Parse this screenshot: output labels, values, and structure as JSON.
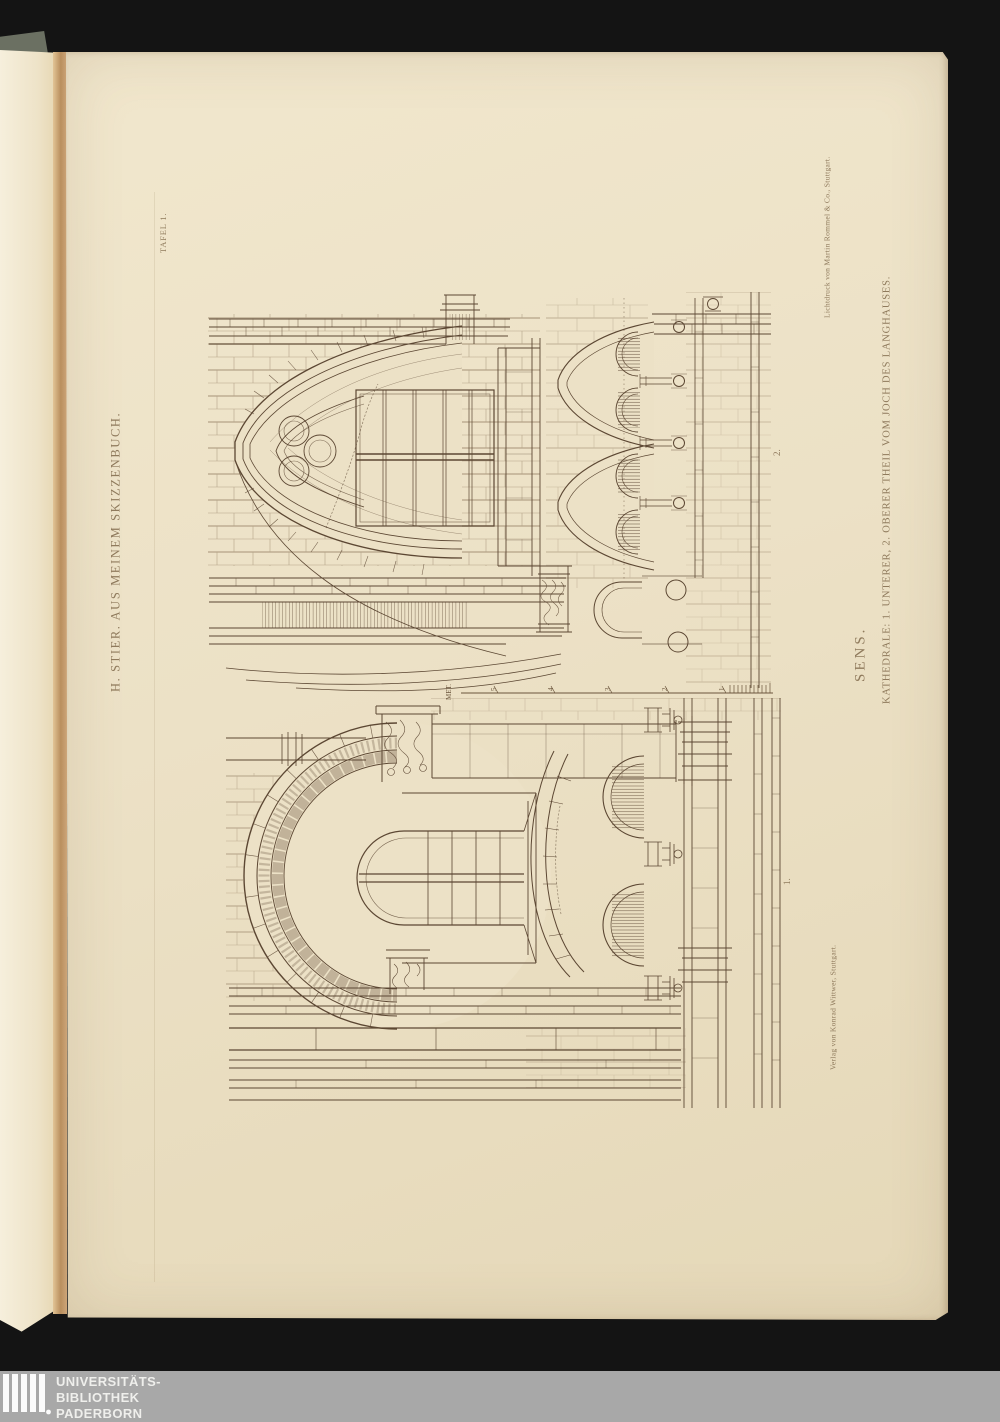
{
  "plate": {
    "tafel_label": "TAFEL 1.",
    "series_title": "H. STIER. AUS MEINEM SKIZZENBUCH.",
    "printer_credit": "Lichtdruck von Martin Rommel & Co., Stuttgart.",
    "publisher_credit": "Verlag von Konrad Wittwer, Stuttgart.",
    "title": "SENS.",
    "caption": "KATHEDRALE: 1. UNTERER, 2. OBERER THEIL VOM JOCH DES LANGHAUSES.",
    "figure_upper_label": "2.",
    "figure_lower_label": "1."
  },
  "scale_bar": {
    "unit_label": "MET.",
    "ticks": [
      "5",
      "4",
      "3",
      "2",
      "1"
    ]
  },
  "watermark": {
    "line1": "UNIVERSITÄTS-",
    "line2": "BIBLIOTHEK",
    "line3": "PADERBORN"
  },
  "colors": {
    "background": "#141414",
    "paper": "#ece1c6",
    "ink": "#5c4733",
    "caption_ink": "#8f7a5c",
    "watermark_band": "#a8a8a8"
  }
}
